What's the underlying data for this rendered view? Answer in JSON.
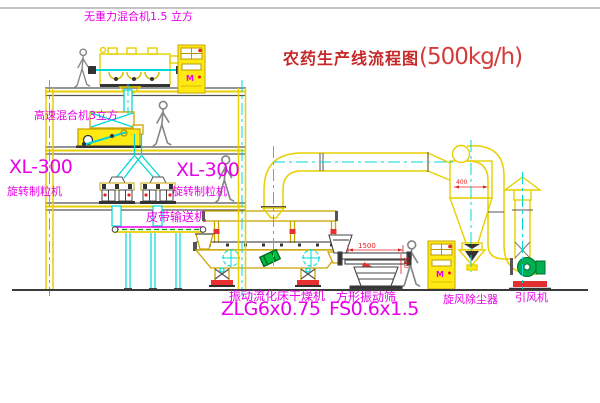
{
  "title": {
    "text": "农药生产线流程图",
    "capacity": "(500kg/h)"
  },
  "labels": {
    "top_mixer": "无重力混合机1.5 立方",
    "mid_mixer": "高速混合机3立方",
    "xl300_left": "XL-300",
    "granulator_left": "旋转制粒机",
    "xl300_right": "XL-300",
    "granulator_right": "旋转制粒机",
    "belt_conveyor": "皮带输送机",
    "dryer_name": "振动流化床干燥机",
    "dryer_model": "ZLG6x0.75",
    "screen_name": "方形振动筛",
    "screen_model": "FS0.6x1.5",
    "cyclone": "旋风除尘器",
    "fan": "引风机"
  },
  "dimensions": {
    "screen_length": "1500",
    "screen_height": "550",
    "cyclone_body": "400"
  },
  "cabinet": {
    "indicator": "M"
  },
  "colors": {
    "equipment_yellow": "#e8cf00",
    "cabinet_fill": "#ffe913",
    "centerline_cyan": "#00d8d8",
    "label_magenta": "#e800e8",
    "dimension_red": "#e02020",
    "title_red": "#c62828",
    "conveyor_green": "#00a000",
    "fan_green": "#00b050",
    "structure_dark": "#555555"
  }
}
